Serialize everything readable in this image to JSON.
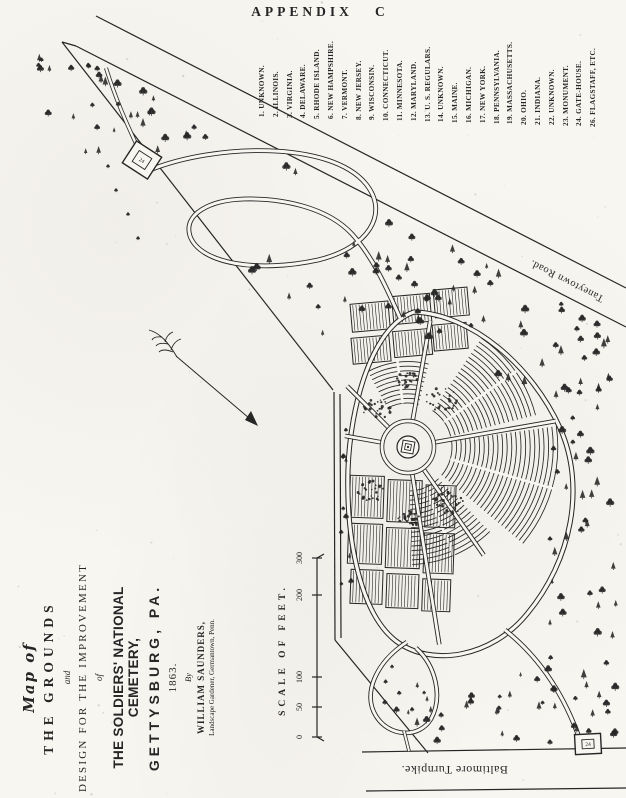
{
  "page": {
    "title": "APPENDIX   C"
  },
  "legend": {
    "items": [
      "1. UNKNOWN.",
      "2. ILLINOIS.",
      "3. VIRGINIA.",
      "4. DELAWARE.",
      "5. RHODE ISLAND.",
      "6. NEW HAMPSHIRE.",
      "7. VERMONT.",
      "8. NEW JERSEY.",
      "9. WISCONSIN.",
      "10. CONNECTICUT.",
      "11. MINNESOTA.",
      "12. MARYLAND.",
      "13. U. S. REGULARS.",
      "14. UNKNOWN.",
      "15. MAINE.",
      "16. MICHIGAN.",
      "17. NEW YORK.",
      "18. PENNSYLVANIA.",
      "19. MASSACHUSETTS.",
      "20. OHIO.",
      "21. INDIANA.",
      "22. UNKNOWN.",
      "23. MONUMENT.",
      "24. GATE-HOUSE.",
      "26. FLAGSTAFF, ETC."
    ]
  },
  "title_block": {
    "map_of": "Map of",
    "grounds": "THE GROUNDS",
    "and_word": "and",
    "design": "DESIGN FOR THE IMPROVEMENT",
    "of_word": "of",
    "cemetery": "THE SOLDIERS' NATIONAL CEMETERY,",
    "gettysburg": "GETTYSBURG, PA.",
    "year": "1863.",
    "by_word": "By",
    "author": "WILLIAM SAUNDERS,",
    "author_sub": "Landscape Gardener, Germantown, Penn."
  },
  "scale": {
    "label": "SCALE OF FEET.",
    "ticks": [
      "0",
      "50",
      "100",
      "200",
      "300"
    ]
  },
  "roads": {
    "taneytown": "Taneytown Road.",
    "baltimore": "Baltimore Turnpike."
  },
  "structures": {
    "gatehouse_top": "24",
    "gatehouse_bottom": "24"
  },
  "colors": {
    "ink": "#262626",
    "paper": "#f8f6f1"
  }
}
